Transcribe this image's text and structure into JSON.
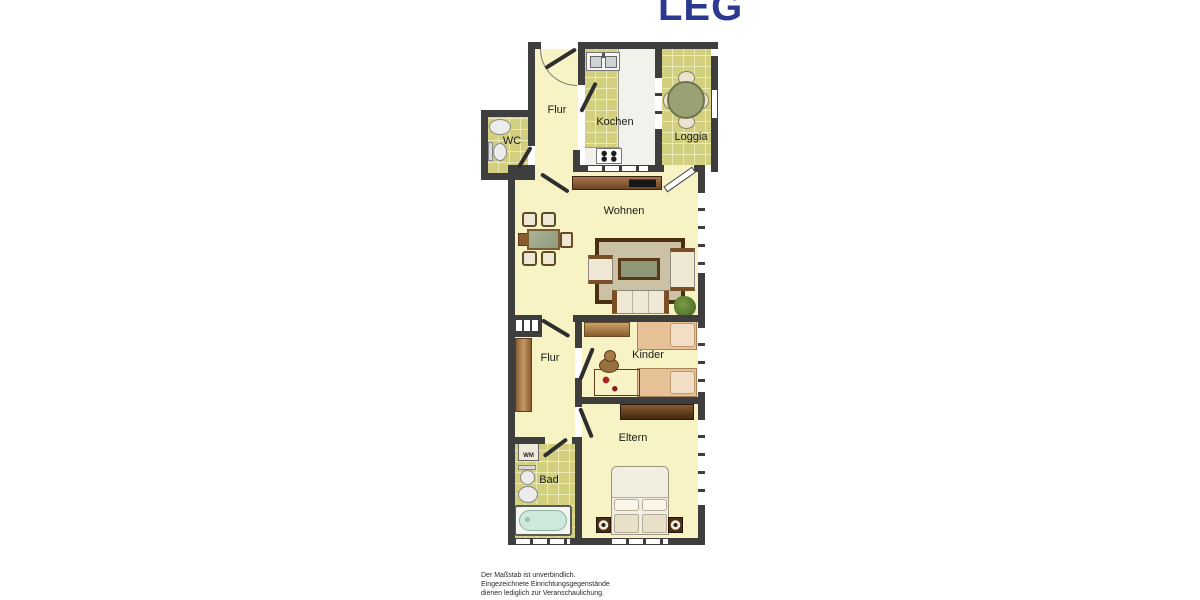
{
  "logo": {
    "text": "LEG",
    "color": "#2b3990"
  },
  "floorplan": {
    "rooms": {
      "flur_top": "Flur",
      "kochen": "Kochen",
      "loggia": "Loggia",
      "wc": "WC",
      "wohnen": "Wohnen",
      "flur_mid": "Flur",
      "kinder": "Kinder",
      "eltern": "Eltern",
      "bad": "Bad"
    },
    "appliances": {
      "washing_machine": "WM"
    },
    "colors": {
      "wall": "#3e3e3e",
      "floor_pale": "#f7f3c5",
      "floor_tile": "#d2cf7e",
      "rug_border": "#4a3010",
      "furniture_brown": "#8a5c30",
      "tub_water": "#cfe8dc"
    }
  },
  "disclaimer": {
    "line1": "Der Maßstab ist unverbindlich.",
    "line2": "Eingezeichnete Einrichtungsgegenstände",
    "line3": "dienen lediglich zur Veranschaulichung."
  }
}
